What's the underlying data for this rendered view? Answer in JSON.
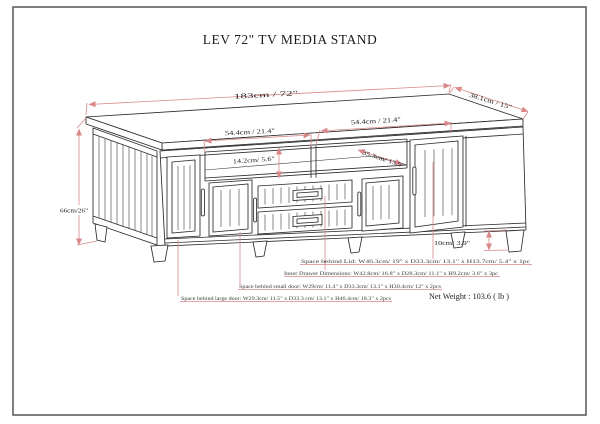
{
  "title": "LEV 72\" TV MEDIA STAND",
  "net_weight": "Net Weight : 103.6 ( lb )",
  "dimensions": {
    "total_width": "183cm / 72\"",
    "depth": "38.1cm / 15\"",
    "opening_left_width": "54.4cm / 21.4\"",
    "opening_right_width": "54.4cm / 21.4\"",
    "opening_height": "14.2cm/ 5.6\"",
    "shelf_depth": "35.3cm/ 13.9\"",
    "total_height": "66cm/26\"",
    "leg_height": "10cm/ 3.9\""
  },
  "notes": [
    "Space behind Lid: W46.3cm/ 19\" x D33.3cm/ 13.1\" x H13.7cm/ 5.4\" x 1pc",
    "Inner Drawer Dimensions: W42.8cm/ 16.8\" x D28.3cm/ 11.1\" x H9.2cm/ 3.6\" x 3pc",
    "Space behind small door: W29cm/ 11.4\" x D33.3cm/ 13.1\" x H30.4cm/ 12\" x 2pcs",
    "Space behind large door: W29.3cm/ 11.5\" x D33.3 cm/ 13.1\" x H46.4cm/ 18.3\" x 2pcs"
  ],
  "colors": {
    "dimension_line": "#d9888a",
    "line_art": "#2b2b2b"
  }
}
